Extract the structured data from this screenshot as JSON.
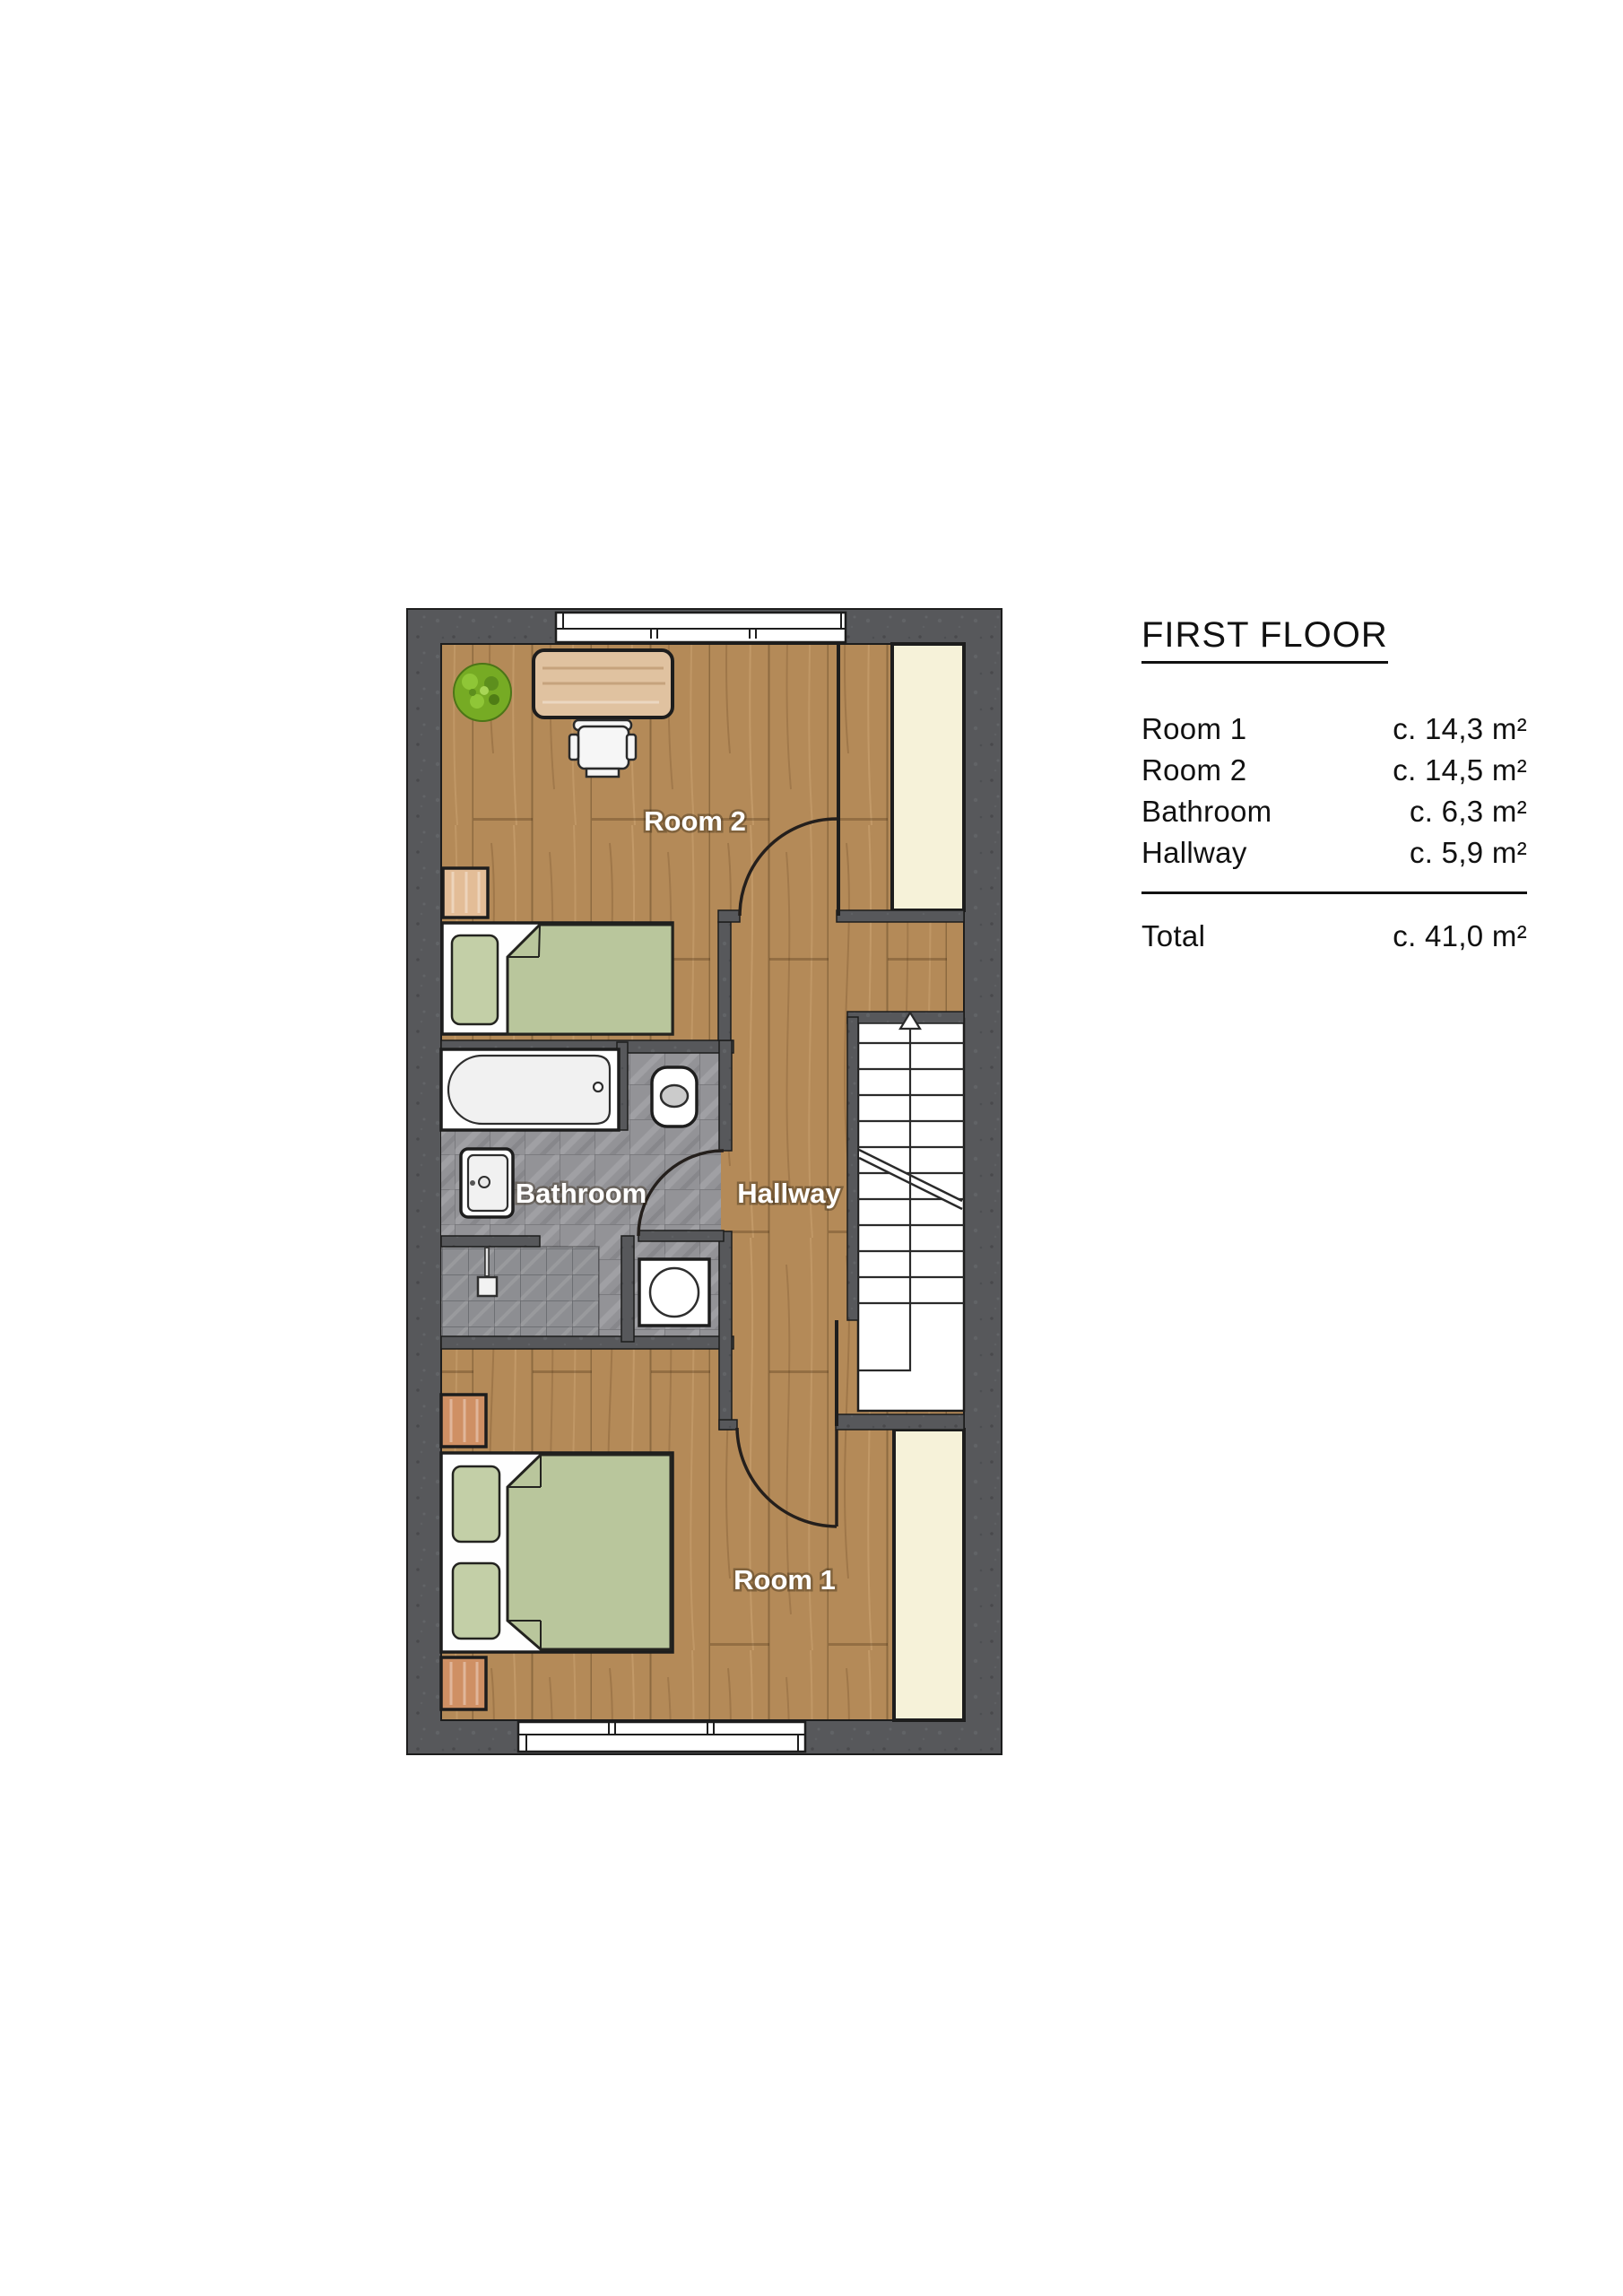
{
  "title": "FIRST FLOOR",
  "legend": {
    "rows": [
      {
        "label": "Room 1",
        "value": "c. 14,3 m²"
      },
      {
        "label": "Room 2",
        "value": "c. 14,5 m²"
      },
      {
        "label": "Bathroom",
        "value": "c. 6,3 m²"
      },
      {
        "label": "Hallway",
        "value": "c. 5,9 m²"
      }
    ],
    "total": {
      "label": "Total",
      "value": "c. 41,0 m²"
    }
  },
  "floorplan": {
    "labels": {
      "room1": "Room 1",
      "room2": "Room 2",
      "bathroom": "Bathroom",
      "hallway": "Hallway"
    },
    "stairs_direction": "up"
  },
  "colors": {
    "wall": "#57585b",
    "wood_floor": "#b48a58",
    "tile": "#939397",
    "closet_cream": "#f6f2d9",
    "bed_green": "#b9c69c",
    "pillow_green": "#c3cfa7",
    "desk_wood": "#e0c2a0",
    "nightstand_wood": "#cf9064",
    "plant_green": "#76ab24",
    "line": "#1d1d1d",
    "plan_label_text": "#ffffff",
    "legend_text": "#111111",
    "background": "#ffffff"
  }
}
